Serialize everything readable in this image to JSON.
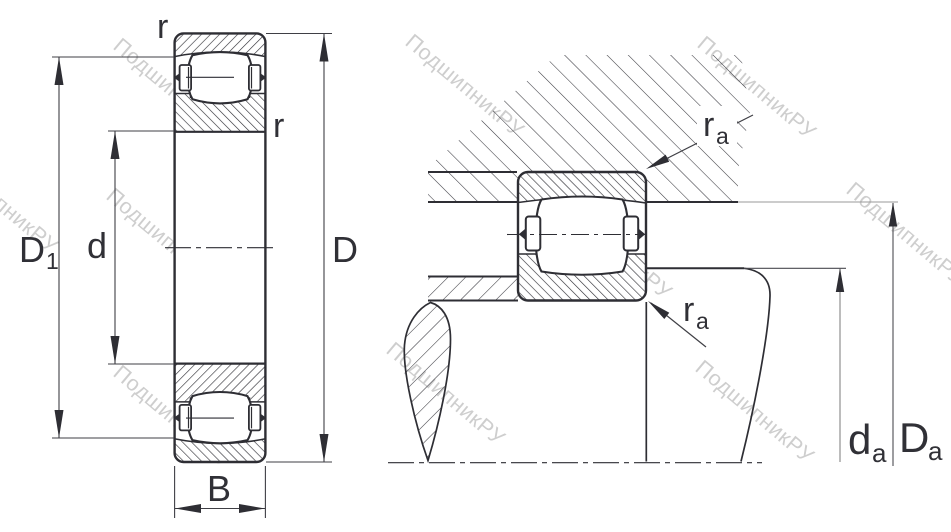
{
  "watermark": {
    "text": "ПодшипникРУ"
  },
  "left_view": {
    "chamfer_top_label": "r",
    "chamfer_bore_label": "r",
    "dim_d1": {
      "base": "D",
      "sub": "1"
    },
    "dim_d": "d",
    "dim_D": "D",
    "dim_B": "B"
  },
  "right_view": {
    "fillet_housing": {
      "base": "r",
      "sub": "a"
    },
    "fillet_shaft": {
      "base": "r",
      "sub": "a"
    },
    "dim_da": {
      "base": "d",
      "sub": "a"
    },
    "dim_Da": {
      "base": "D",
      "sub": "a"
    }
  },
  "colors": {
    "line": "#2e2e34",
    "thin_line": "#3f3f45",
    "gray_line": "#9a9a9a",
    "watermark": "#c6c6c6",
    "background": "#ffffff"
  }
}
